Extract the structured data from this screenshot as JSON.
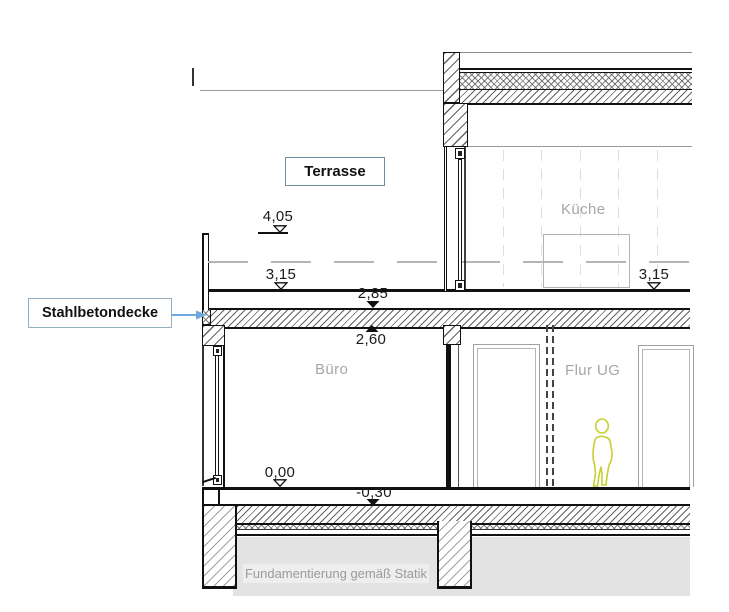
{
  "drawing": {
    "title_hint": "building-section",
    "rooms": {
      "kueche": "Küche",
      "buero": "Büro",
      "flur_ug": "Flur UG"
    },
    "annotations": {
      "terrasse": "Terrasse",
      "stahlbetondecke": "Stahlbetondecke",
      "fundament": "Fundamentierung gemäß Statik"
    },
    "levels": {
      "l405": "4,05",
      "l315_left": "3,15",
      "l315_right": "3,15",
      "l285": "2,85",
      "l260": "2,60",
      "l000": "0,00",
      "lm030": "-0,30"
    },
    "colors": {
      "callout_border_light": "#8fb0c4",
      "callout_border_dark": "#6c8fa4",
      "arrow_blue": "#6fa8dc",
      "figure_outline": "#c9cf2e",
      "room_text": "#a6a6a6",
      "earth_fill": "#e3e3e3",
      "line_black": "#111111",
      "line_gray": "#999999"
    }
  }
}
